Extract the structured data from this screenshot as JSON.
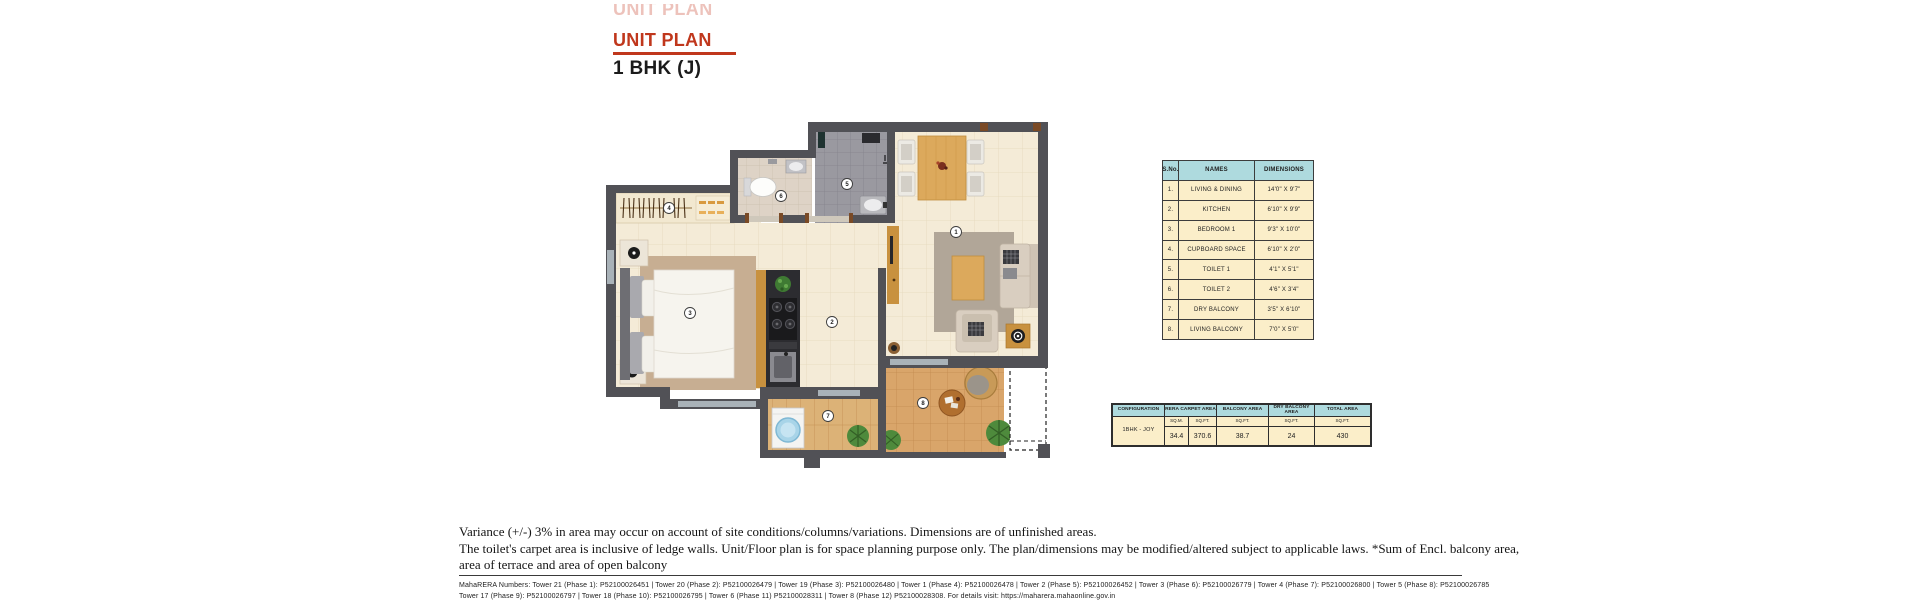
{
  "header": {
    "ghost_title": "UNIT PLAN",
    "title": "UNIT PLAN",
    "subtitle": "1 BHK (J)"
  },
  "colors": {
    "accent_red": "#c0371c",
    "table_header_bg": "#aedade",
    "table_row_bg": "#fbeec9",
    "wall_gray": "#515156"
  },
  "dimension_table": {
    "headers": {
      "sno": "S.No.",
      "name": "NAMES",
      "dim": "DIMENSIONS"
    },
    "rows": [
      {
        "sno": "1.",
        "name": "LIVING & DINING",
        "dim": "14'0\" X 9'7\""
      },
      {
        "sno": "2.",
        "name": "KITCHEN",
        "dim": "6'10\" X 9'9\""
      },
      {
        "sno": "3.",
        "name": "BEDROOM 1",
        "dim": "9'3\" X 10'0\""
      },
      {
        "sno": "4.",
        "name": "CUPBOARD SPACE",
        "dim": "6'10\" X 2'0\""
      },
      {
        "sno": "5.",
        "name": "TOILET 1",
        "dim": "4'1\" X 5'1\""
      },
      {
        "sno": "6.",
        "name": "TOILET 2",
        "dim": "4'6\" X 3'4\""
      },
      {
        "sno": "7.",
        "name": "DRY BALCONY",
        "dim": "3'5\" X 6'10\""
      },
      {
        "sno": "8.",
        "name": "LIVING BALCONY",
        "dim": "7'0\" X 5'0\""
      }
    ]
  },
  "area_table": {
    "config_header": "CONFIGURATION",
    "config_value": "1BHK - JOY",
    "rera_header": "RERA CARPET AREA",
    "balcony_header": "BALCONY AREA",
    "dry_balcony_header": "DRY BALCONY AREA",
    "total_header": "TOTAL AREA",
    "units": {
      "sqm": "SQ.M.",
      "sqft": "SQ.FT."
    },
    "values": {
      "rera_sqm": "34.4",
      "rera_sqft": "370.6",
      "balcony_sqft": "38.7",
      "dry_balcony_sqft": "24",
      "total_sqft": "430"
    }
  },
  "plan_markers": {
    "m1": "1",
    "m2": "2",
    "m3": "3",
    "m4": "4",
    "m5": "5",
    "m6": "6",
    "m7": "7",
    "m8": "8"
  },
  "disclaimer": {
    "line1": "Variance (+/-) 3% in area may occur on account of site conditions/columns/variations. Dimensions are of unfinished areas.",
    "line2": "The toilet's carpet area is inclusive of ledge walls. Unit/Floor plan is for space planning purpose only. The plan/dimensions may be modified/altered subject to applicable laws. *Sum of Encl. balcony area,",
    "line3": "area of terrace and area of open balcony"
  },
  "footer": {
    "line1": "MahaRERA Numbers: Tower 21 (Phase 1): P52100026451 | Tower 20 (Phase 2): P52100026479 | Tower 19 (Phase 3): P52100026480 | Tower 1 (Phase 4): P52100026478 | Tower 2 (Phase 5): P52100026452 | Tower 3 (Phase 6): P52100026779 | Tower 4 (Phase 7): P52100026800 | Tower 5 (Phase 8): P52100026785",
    "line2": "Tower 17 (Phase 9): P52100026797 | Tower 18 (Phase 10): P52100026795 | Tower 6 (Phase 11) P52100028311 | Tower 8 (Phase 12) P52100028308. For details visit: https://maharera.mahaonline.gov.in"
  }
}
